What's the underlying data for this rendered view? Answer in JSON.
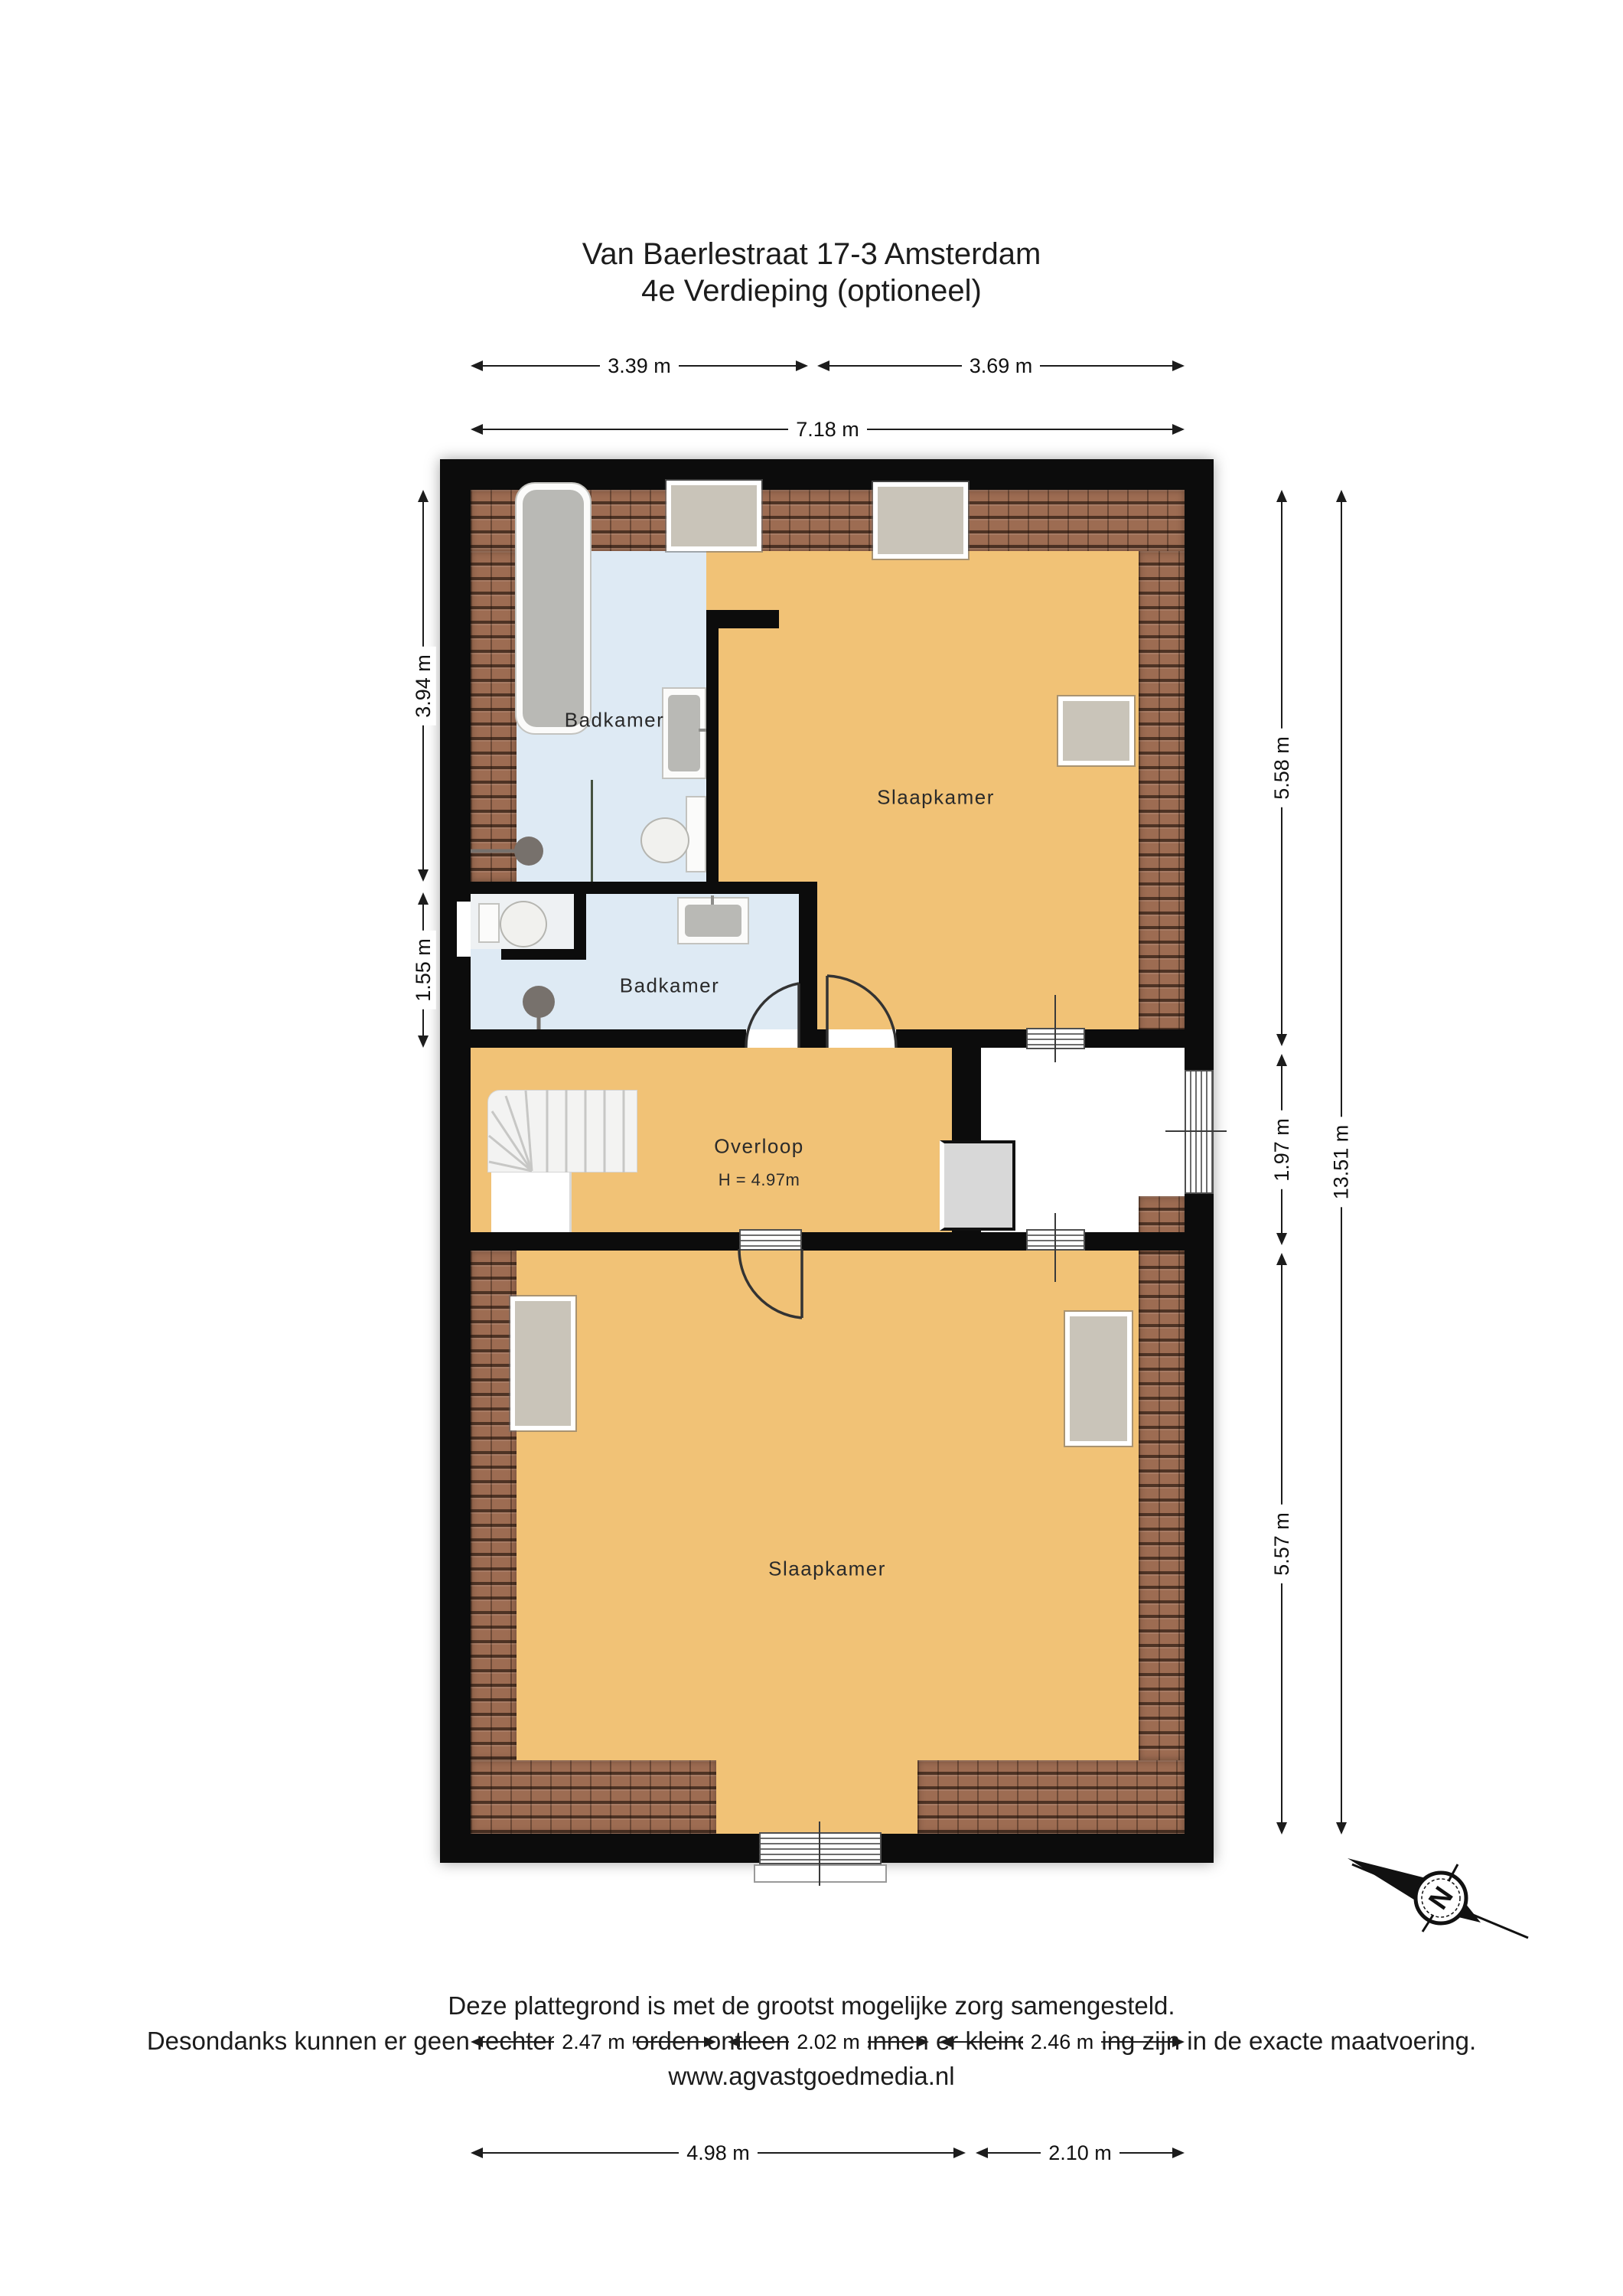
{
  "title": {
    "line1": "Van Baerlestraat 17-3 Amsterdam",
    "line2": "4e Verdieping (optioneel)"
  },
  "labels": {
    "badkamer_1": "Badkamer",
    "badkamer_2": "Badkamer",
    "slaapkamer_1": "Slaapkamer",
    "slaapkamer_2": "Slaapkamer",
    "overloop": "Overloop",
    "overloop_height": "H = 4.97m"
  },
  "dimensions": {
    "top": [
      {
        "label": "3.39 m"
      },
      {
        "label": "3.69 m"
      },
      {
        "label": "7.18 m"
      }
    ],
    "left": [
      {
        "label": "3.94 m"
      },
      {
        "label": "1.55 m"
      }
    ],
    "right": [
      {
        "label": "5.58 m"
      },
      {
        "label": "1.97 m"
      },
      {
        "label": "5.57 m"
      },
      {
        "label": "13.51 m"
      }
    ],
    "bottom": [
      {
        "label": "2.47 m"
      },
      {
        "label": "2.02 m"
      },
      {
        "label": "2.46 m"
      },
      {
        "label": "4.98 m"
      },
      {
        "label": "2.10 m"
      }
    ]
  },
  "footer": {
    "line1": "Deze plattegrond is met de grootst mogelijke zorg samengesteld.",
    "line2": "Desondanks kunnen er geen rechten aan worden ontleend en kunnen er kleine afwijking zijn in de exacte maatvoering.",
    "line3": "www.agvastgoedmedia.nl"
  },
  "compass": {
    "north_label": "N"
  },
  "colors": {
    "floor_orange": "#F1C276",
    "bathroom_blue": "#DEEAF4",
    "wall_black": "#0C0C0C",
    "roof_tiles": "#9D6C52",
    "window_fill": "#C9C4B9"
  }
}
